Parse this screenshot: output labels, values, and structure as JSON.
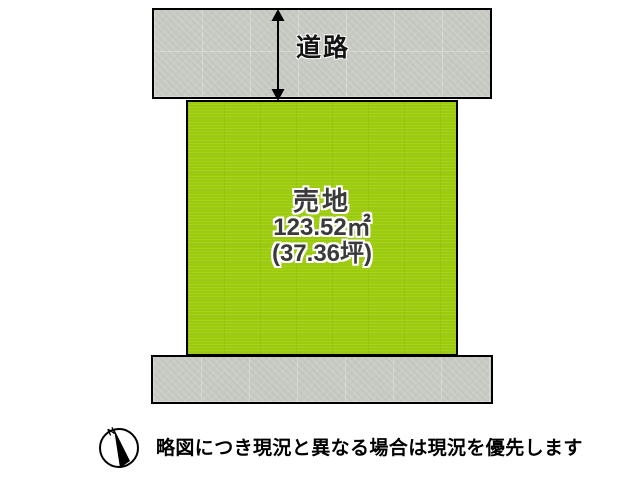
{
  "colors": {
    "lot_green": "#9bcb0b",
    "road_gray": "#c9cbc5",
    "border_black": "#000000",
    "lot_text": "#3a3a3a",
    "outline_white": "#ffffff"
  },
  "road_top": {
    "label": "道路"
  },
  "lot": {
    "title": "売地",
    "area_m2": "123.52㎡",
    "area_tsubo": "(37.36坪)"
  },
  "compass": {
    "north_label": "N"
  },
  "footer": {
    "disclaimer": "略図につき現況と異なる場合は現況を優先します"
  }
}
